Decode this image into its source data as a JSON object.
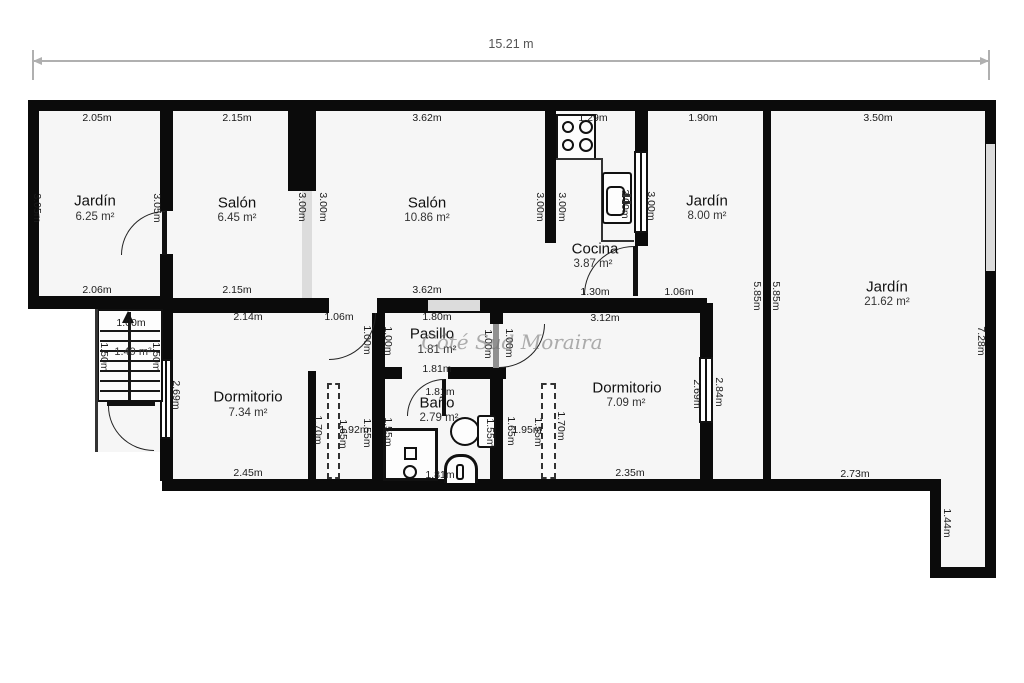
{
  "plan": {
    "total_width_label": "15.21 m",
    "watermark": "Côté Sud Moraira",
    "rooms": {
      "jardin1": {
        "name": "Jardín",
        "area": "6.25 m²"
      },
      "salon1": {
        "name": "Salón",
        "area": "6.45 m²"
      },
      "salon2": {
        "name": "Salón",
        "area": "10.86 m²"
      },
      "cocina": {
        "name": "Cocina",
        "area": "3.87 m²"
      },
      "jardin2": {
        "name": "Jardín",
        "area": "8.00 m²"
      },
      "jardin3": {
        "name": "Jardín",
        "area": "21.62 m²"
      },
      "stairs": {
        "area": "1.49 m²"
      },
      "pasillo": {
        "name": "Pasillo",
        "area": "1.81 m²"
      },
      "bano": {
        "name": "Baño",
        "area": "2.79 m²"
      },
      "dorm1": {
        "name": "Dormitorio",
        "area": "7.34 m²"
      },
      "dorm2": {
        "name": "Dormitorio",
        "area": "7.09 m²"
      }
    },
    "dims": {
      "j1_top": "2.05m",
      "j1_bottom": "2.06m",
      "j1_left": "3.05m",
      "j1_right": "3.05m",
      "s1_top": "2.15m",
      "s1_bottom": "2.15m",
      "s1_right": "3.00m",
      "s2_left": "3.00m",
      "s2_top": "3.62m",
      "s2_bottom": "3.62m",
      "s2_right": "3.00m",
      "cocina_left": "3.00m",
      "cocina_top": "1.29m",
      "cocina_bottom": "1.30m",
      "cocina_right": "3.00m",
      "j2_left": "3.00m",
      "j2_top": "1.90m",
      "j2_bottom": "1.06m",
      "j3_top": "3.50m",
      "divider_left": "5.85m",
      "divider_right": "5.85m",
      "j3_right": "7.28m",
      "j3_bottom": "2.73m",
      "notch_right": "1.44m",
      "stairs_top": "1.00m",
      "stairs_left": "1.50m",
      "stairs_right": "1.50m",
      "d1_top": "2.14m",
      "d1_door": "1.06m",
      "d1_door_side": "1.00m",
      "d1_left": "2.69m",
      "d1_bottom": "2.45m",
      "pasillo_top": "1.80m",
      "pasillo_left": "1.00m",
      "pasillo_bottom": "1.81m",
      "pasillo_right": "1.00m",
      "d2_door_side": "1.00m",
      "strip1_wardrobe": "1.70m",
      "strip1_a": "1.65m",
      "strip1_b": "1.92m",
      "strip1_c": "1.55m",
      "bano_top": "1.81m",
      "bano_left": "1.55m",
      "bano_tank": "1.55m",
      "bano_bottom": "1.81m",
      "strip2_a": "1.65m",
      "strip2_b": "1.95m",
      "strip2_c": "1.55m",
      "strip2_wardrobe": "1.70m",
      "d2_top": "3.12m",
      "d2_bottom": "2.35m",
      "d2_right": "2.69m",
      "d2_right_out": "2.84m"
    }
  }
}
